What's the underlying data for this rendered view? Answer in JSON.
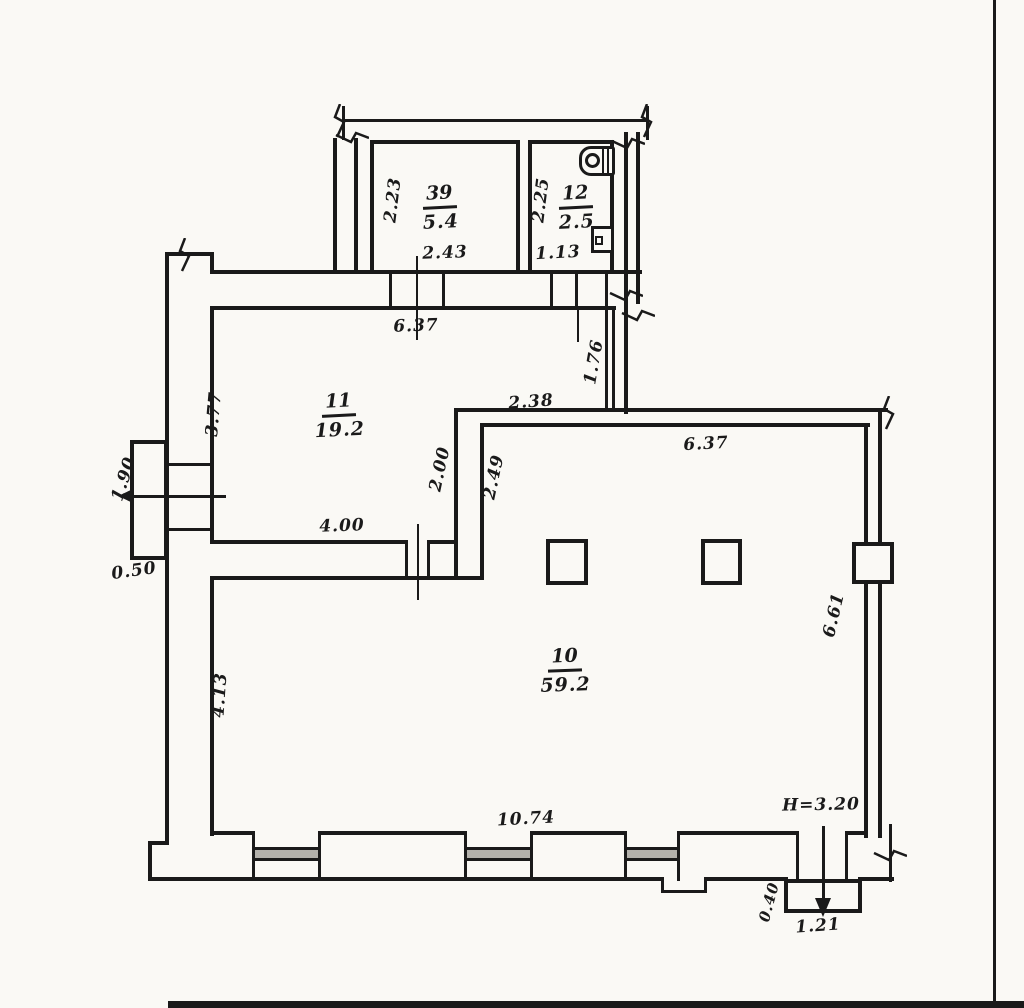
{
  "plan": {
    "title": "Scanned apartment floor plan",
    "rooms": [
      {
        "number": "39",
        "area": "5.4"
      },
      {
        "number": "12",
        "area": "2.5"
      },
      {
        "number": "11",
        "area": "19.2"
      },
      {
        "number": "10",
        "area": "59.2"
      }
    ],
    "dimensions": {
      "room39_height": "2.23",
      "room39_width": "2.43",
      "room12_height": "2.25",
      "room12_width": "1.13",
      "hall_width": "6.37",
      "hall_height": "3.77",
      "jog_height": "1.76",
      "niche_width": "2.38",
      "wall_seg_a": "2.00",
      "wall_seg_b": "2.49",
      "main_top_width": "6.37",
      "main_right_height": "6.61",
      "main_left_height": "4.13",
      "main_bottom_width": "10.74",
      "entry_width": "1.90",
      "entry_depth": "0.50",
      "opening_width": "4.00",
      "ceiling_height": "H=3.20",
      "porch_depth": "0.40",
      "porch_width": "1.21"
    },
    "colors": {
      "ink": "#1a1a1a",
      "paper": "#faf9f5",
      "window_hatch": "#b3b1ab"
    }
  }
}
